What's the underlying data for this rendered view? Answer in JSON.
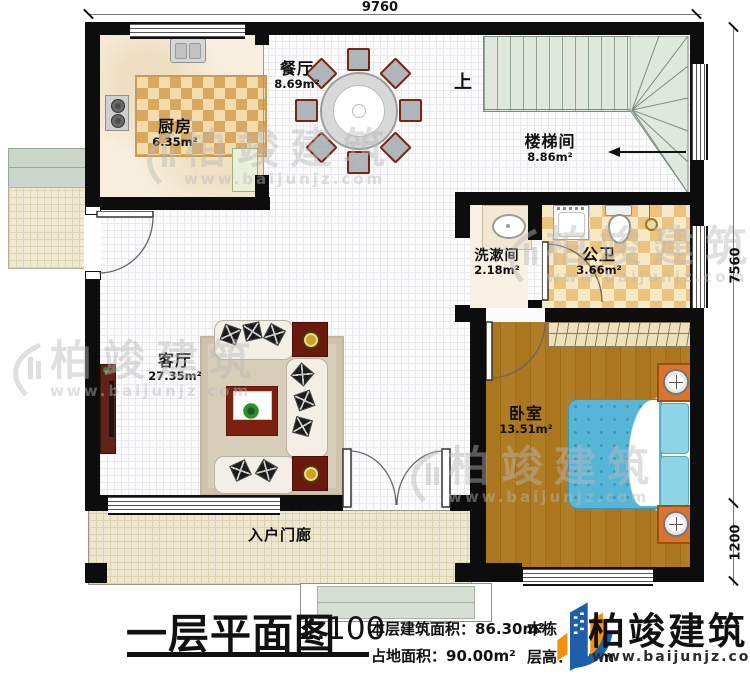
{
  "dimensions": {
    "top": "9760",
    "right_upper": "7560",
    "right_lower": "1200"
  },
  "rooms": {
    "kitchen": {
      "name": "厨房",
      "area": "6.35m²"
    },
    "dining": {
      "name": "餐厅",
      "area": "8.69m²"
    },
    "stairwell": {
      "name": "楼梯间",
      "area": "8.86m²",
      "up": "上"
    },
    "washroom": {
      "name": "洗漱间",
      "area": "2.18m²"
    },
    "bathroom": {
      "name": "公卫",
      "area": "3.66m²"
    },
    "living": {
      "name": "客厅",
      "area": "27.35m²"
    },
    "bedroom": {
      "name": "卧室",
      "area": "13.51m²"
    },
    "porch": {
      "name": "入户门廊"
    }
  },
  "titleblock": {
    "title": "一层平面图",
    "scale": "1:100",
    "floor_area_label": "本层建筑面积：",
    "floor_area_value": "86.30m²",
    "site_area_label": "占地面积：",
    "site_area_value": "90.00m²",
    "partial_left_text": "本栋",
    "storey_height": "层高：3.6m"
  },
  "brand": {
    "name": "柏竣建筑",
    "url": "www.baijunjz.com"
  },
  "watermark": {
    "name": "柏竣建筑",
    "url": "www.baijunjz.com"
  }
}
